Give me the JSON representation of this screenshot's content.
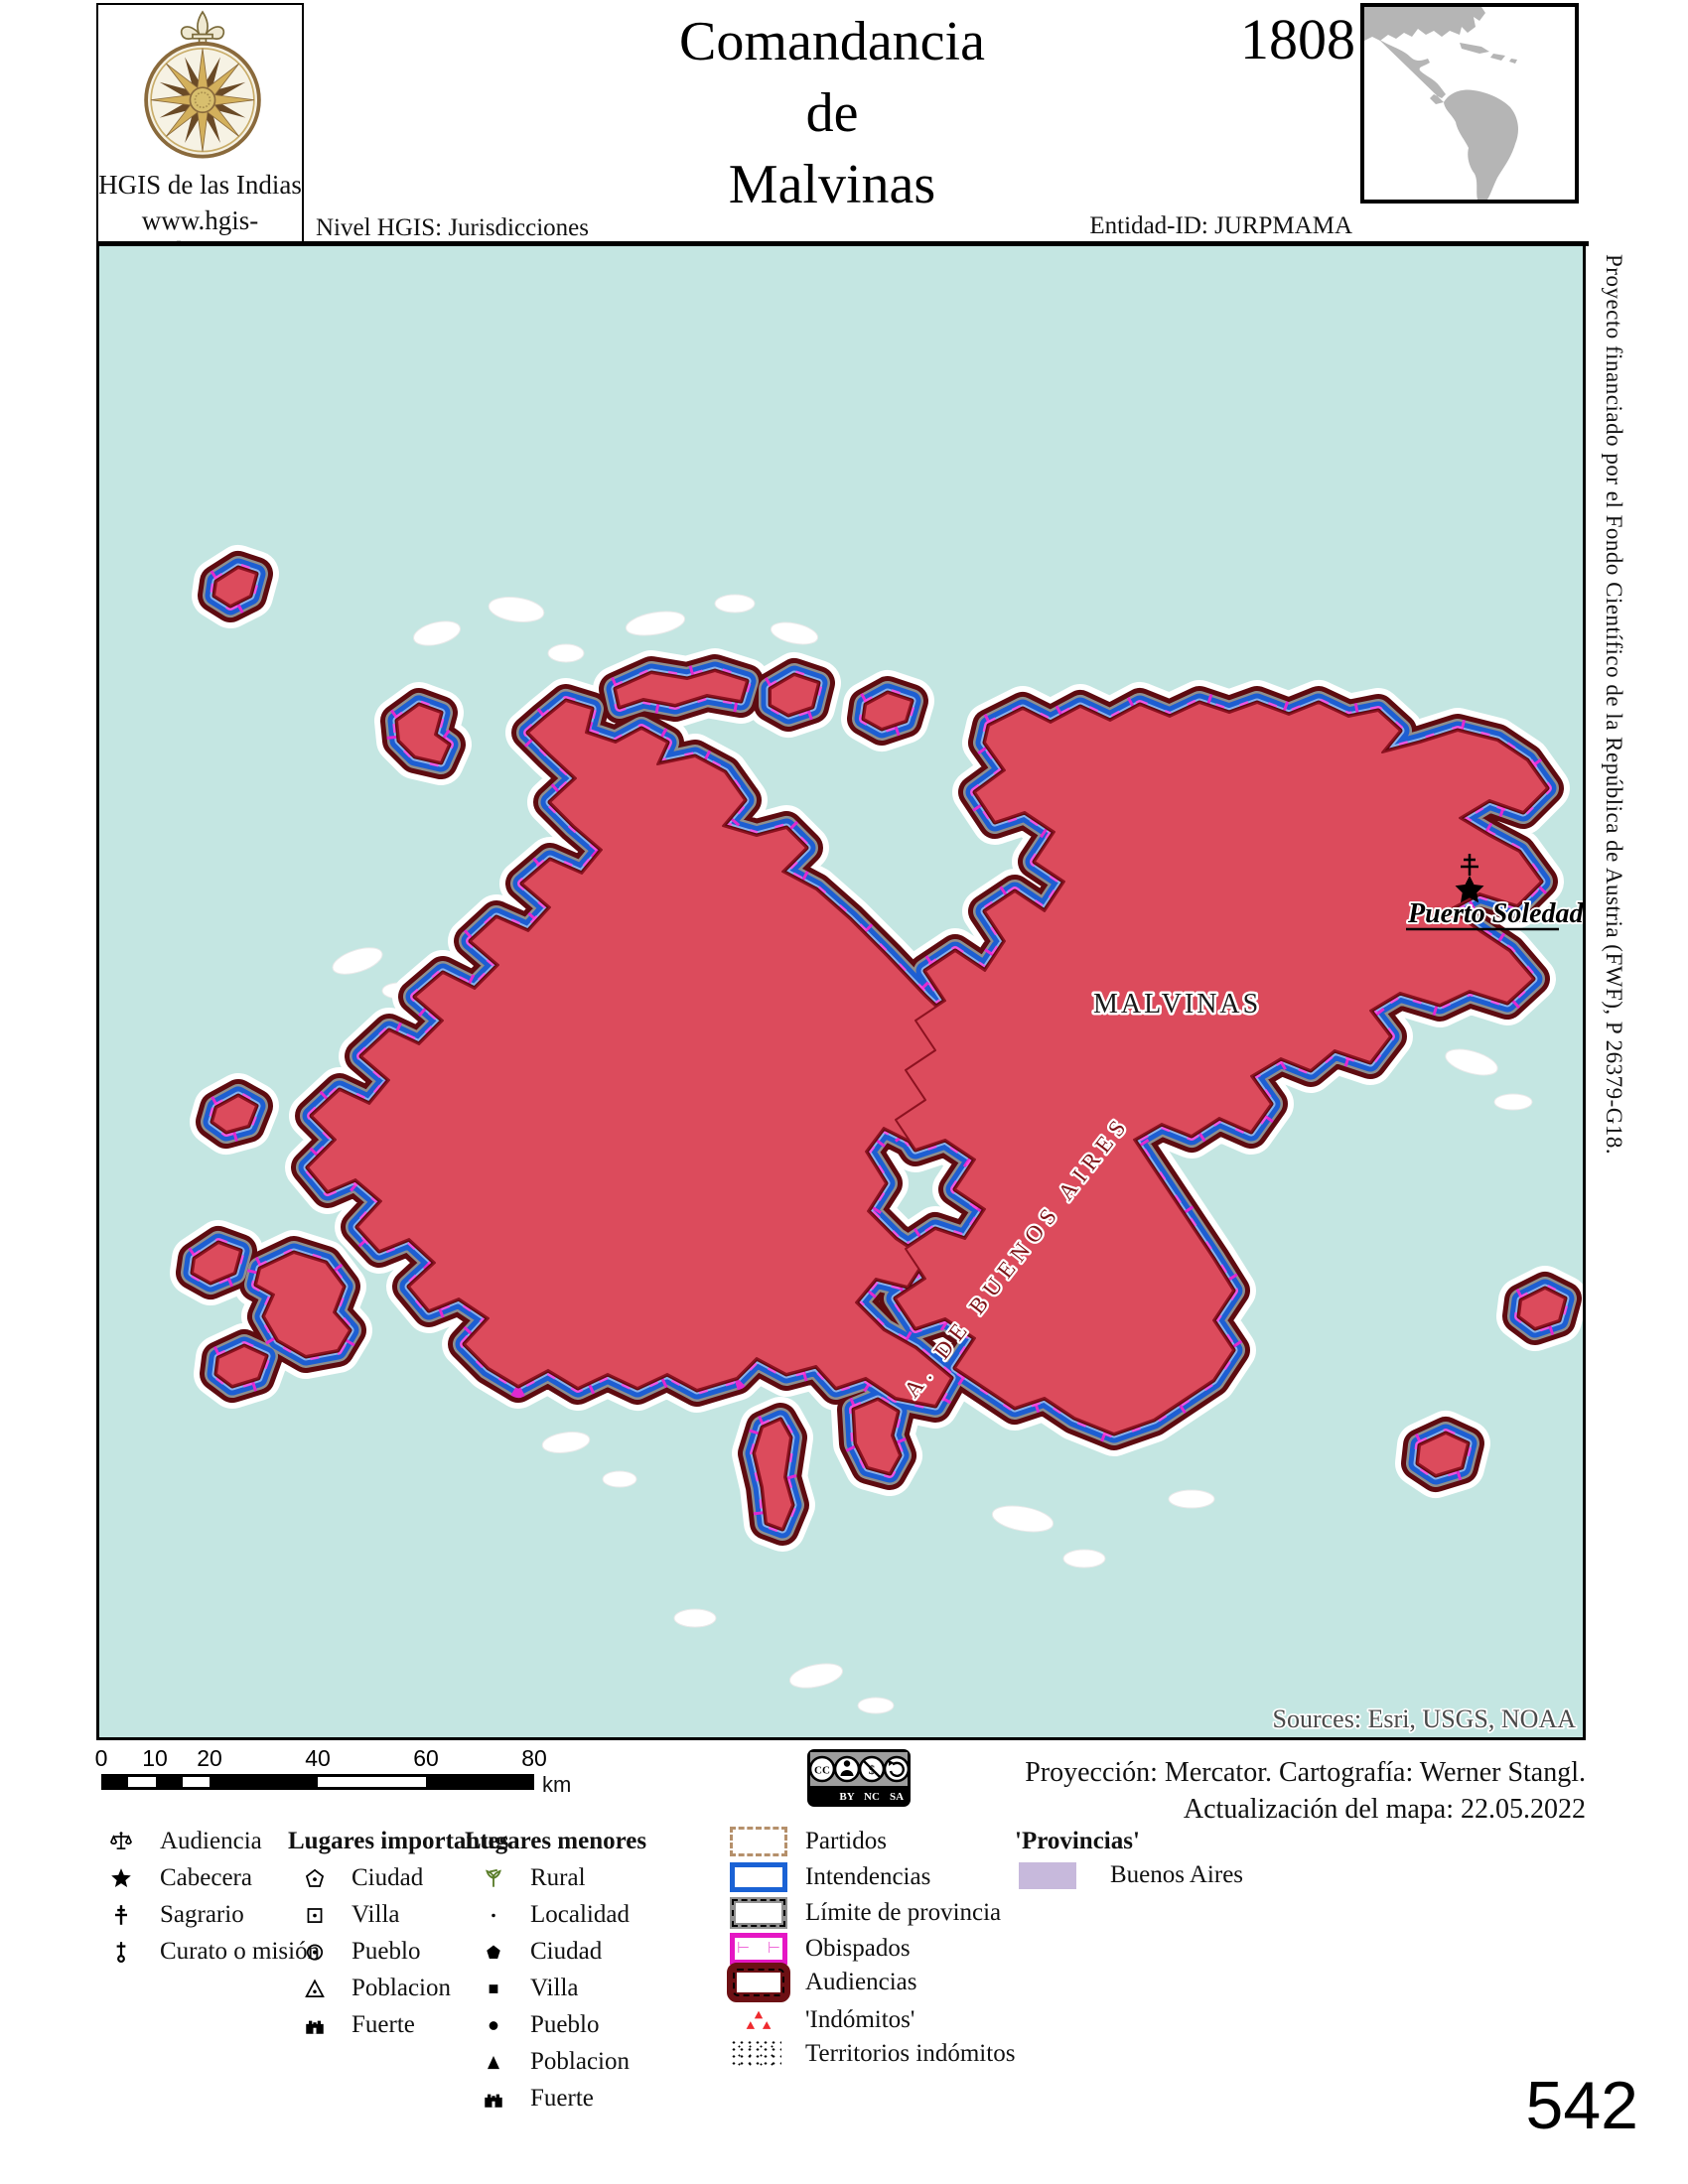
{
  "header": {
    "site_name": "HGIS de las Indias",
    "site_url": "www.hgis-indias.net",
    "title_lines": [
      "Comandancia",
      "de",
      "Malvinas"
    ],
    "year": "1808",
    "level_label": "Nivel HGIS: Jurisdicciones",
    "entity_label": "Entidad-ID: JURPMAMA"
  },
  "side_note": "Proyecto financiado por el Fondo Científico de la República de Austria (FWF),  P 26379-G18.",
  "map": {
    "labels": {
      "territory": "MALVINAS",
      "settlement": "Puerto Soledad",
      "neighbor": "A. DE BUENOS AIRES"
    },
    "sources": "Sources: Esri, USGS, NOAA",
    "colors": {
      "water": "#c4e6e2",
      "island_fill": "#dc4b5c",
      "audiencia_border": "#5e0b10",
      "intendencia_border": "#1d5ed2",
      "obispado_ticks": "#e02ad0",
      "inset_land": "#b5b5b5"
    }
  },
  "scalebar": {
    "ticks": [
      "0",
      "10",
      "20",
      "40",
      "60",
      "80"
    ],
    "unit": "km"
  },
  "attribution": {
    "cc_initials": "CC",
    "cc_terms": [
      "BY",
      "NC",
      "SA"
    ],
    "projection": "Proyección: Mercator. Cartografía: Werner Stangl.",
    "updated": "Actualización del mapa: 22.05.2022"
  },
  "legend": {
    "institutions": [
      {
        "icon": "scales-icon",
        "label": "Audiencia"
      },
      {
        "icon": "star-icon",
        "label": "Cabecera"
      },
      {
        "icon": "patriarchal-cross-icon",
        "label": "Sagrario"
      },
      {
        "icon": "mission-cross-icon",
        "label": "Curato o misión"
      }
    ],
    "important_header": "Lugares importantes",
    "important": [
      {
        "icon": "pentagon-outline-icon",
        "label": "Ciudad"
      },
      {
        "icon": "square-outline-icon",
        "label": "Villa"
      },
      {
        "icon": "circle-outline-icon",
        "label": "Pueblo"
      },
      {
        "icon": "triangle-outline-icon",
        "label": "Poblacion"
      },
      {
        "icon": "castle-icon",
        "label": "Fuerte"
      }
    ],
    "minor_header": "Lugares menores",
    "minor": [
      {
        "icon": "plant-icon",
        "label": "Rural"
      },
      {
        "icon": "small-dot-icon",
        "label": "Localidad"
      },
      {
        "icon": "pentagon-filled-icon",
        "label": "Ciudad"
      },
      {
        "icon": "square-filled-icon",
        "label": "Villa"
      },
      {
        "icon": "circle-filled-icon",
        "label": "Pueblo"
      },
      {
        "icon": "triangle-filled-icon",
        "label": "Poblacion"
      },
      {
        "icon": "castle-icon",
        "label": "Fuerte"
      }
    ],
    "boundaries": [
      {
        "swatch": "partidos",
        "label": "Partidos"
      },
      {
        "swatch": "intendencias",
        "label": "Intendencias"
      },
      {
        "swatch": "limite-provincia",
        "label": "Límite de provincia"
      },
      {
        "swatch": "obispados",
        "label": "Obispados"
      },
      {
        "swatch": "audiencias",
        "label": "Audiencias"
      },
      {
        "swatch": "indomitos",
        "label": "'Indómitos'"
      },
      {
        "swatch": "territorios-indomitos",
        "label": "Territorios indómitos"
      }
    ],
    "provinces_header": "'Provincias'",
    "provinces": [
      {
        "label": "Buenos Aires",
        "color": "#c7b9dc"
      }
    ]
  },
  "page_number": "542"
}
